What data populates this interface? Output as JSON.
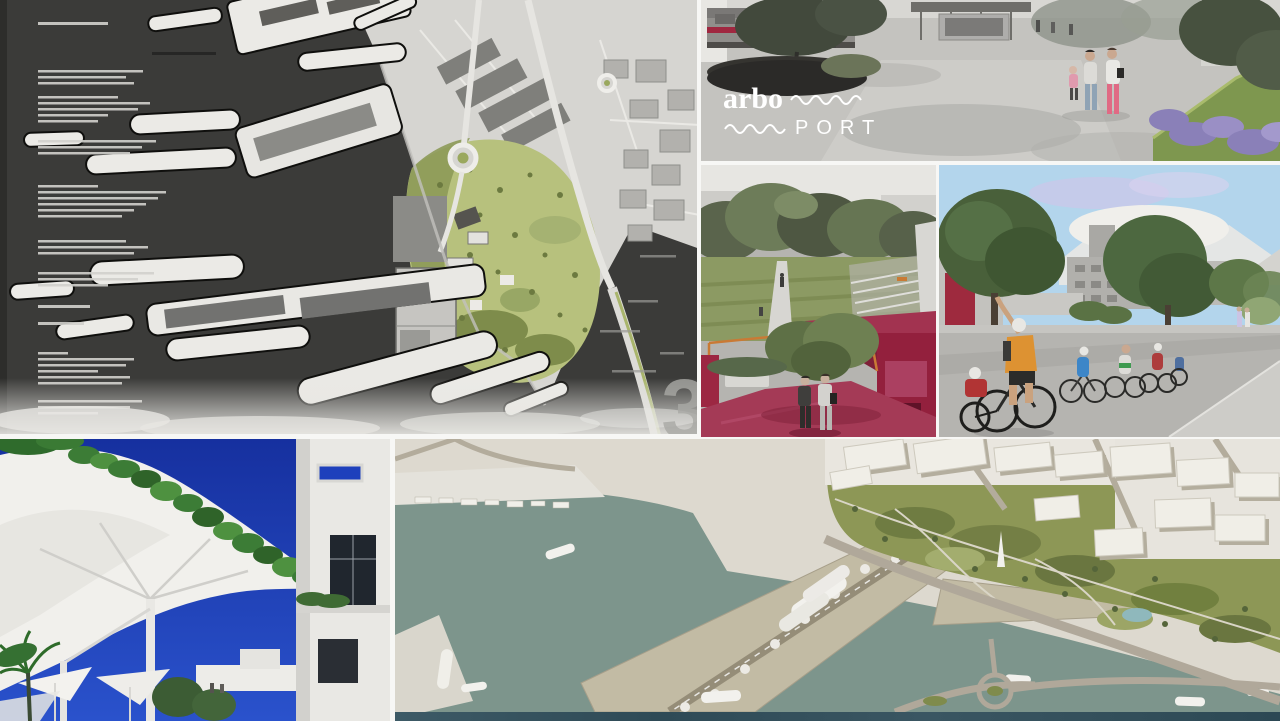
{
  "branding": {
    "logo_primary": "arbo",
    "logo_secondary": "PORT",
    "sheet_number": "3"
  },
  "panels": {
    "site_plan": {
      "name": "masterplan-site-plan",
      "water": "#3b3b39",
      "land": "#d6d5d1",
      "park": "#b7c17d"
    },
    "promenade": {
      "name": "station-promenade-rendering",
      "accent_crimson": "#a02740",
      "accent_pink": "#e06a84",
      "accent_lavender": "#8a80b8"
    },
    "park_path": {
      "name": "linear-park-path-rendering",
      "pavilion_crimson": "#a23350",
      "frame_orange": "#c97a35"
    },
    "cycleway": {
      "name": "cycleway-street-rendering",
      "sky": "#b3d5ec",
      "vest_orange": "#dd9232"
    },
    "canopy": {
      "name": "canopy-plaza-rendering",
      "sky": "#1c3cb6"
    },
    "aerial": {
      "name": "aerial-port-rendering",
      "water": "#7d958c",
      "pier": "#c2bba4",
      "park": "#8d9756"
    }
  }
}
